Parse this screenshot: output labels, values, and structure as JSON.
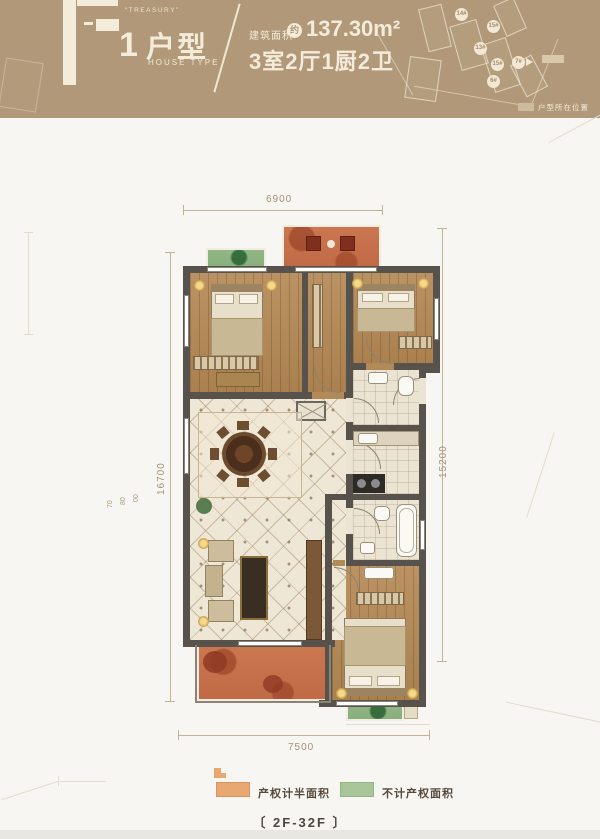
{
  "header": {
    "brand_letter": "F",
    "brand_slogan": "“TREASURY”",
    "unit_index": "1",
    "unit_label_cn": "户型",
    "unit_label_en": "HOUSE TYPE",
    "area_prefix": "建筑面积",
    "area_circle": "约",
    "area_value": "137.30m²",
    "rooms_text": "3室2厅1厨2卫",
    "siteplan": {
      "building_labels": [
        "14#",
        "15#",
        "13#",
        "15#",
        "7#",
        "6#"
      ],
      "location_label": "户型所在位置"
    }
  },
  "dimensions": {
    "top": "6900",
    "bottom": "7500",
    "left_total": "16700",
    "right_total": "15200",
    "left_segments": [
      "70",
      "80",
      "00"
    ],
    "right_segments": [
      "30",
      "30"
    ]
  },
  "legend": {
    "orange_label": "产权计半面积",
    "green_label": "不计产权面积",
    "orange_color": "#e9a871",
    "green_color": "#a9c69b"
  },
  "footer": {
    "floor_range": "〔 2F-32F 〕"
  },
  "colors": {
    "header_bg": "#b19878",
    "cream_text": "#f4ecdb",
    "wall": "#57524b",
    "wood_floor": "#b68e5e",
    "tile_floor": "#efe7d6",
    "balcony_orange": "#c8714a",
    "planter_green": "#8fb585"
  }
}
